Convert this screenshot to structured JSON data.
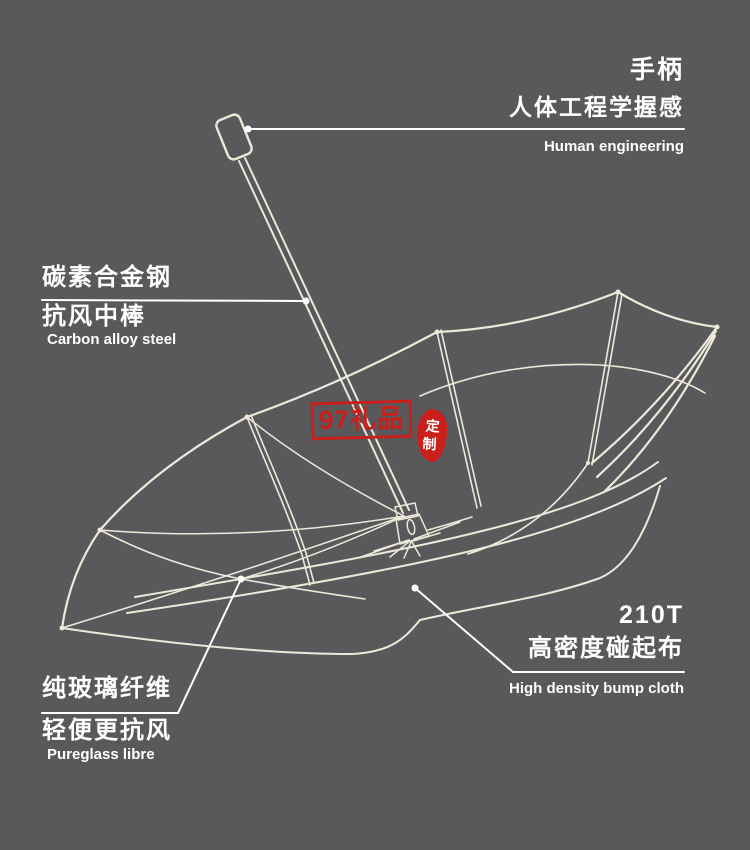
{
  "canvas": {
    "background": "#59595b",
    "line_color": "#ece9da",
    "text_color": "#ffffff",
    "accent_red": "#c9201b"
  },
  "callouts": {
    "handle": {
      "title": "手柄",
      "subtitle": "人体工程学握感",
      "caption": "Human engineering"
    },
    "shaft": {
      "title": "碳素合金钢",
      "subtitle": "抗风中棒",
      "caption": "Carbon alloy steel"
    },
    "ribs": {
      "title": "纯玻璃纤维",
      "subtitle": "轻便更抗风",
      "caption": "Pureglass libre"
    },
    "canopy": {
      "title": "210T",
      "subtitle": "高密度碰起布",
      "caption": "High density bump cloth"
    }
  },
  "watermark": {
    "brand": "97礼品",
    "seal_top": "定",
    "seal_bottom": "制"
  },
  "icons": {
    "leader_dot": "callout anchor dot"
  }
}
